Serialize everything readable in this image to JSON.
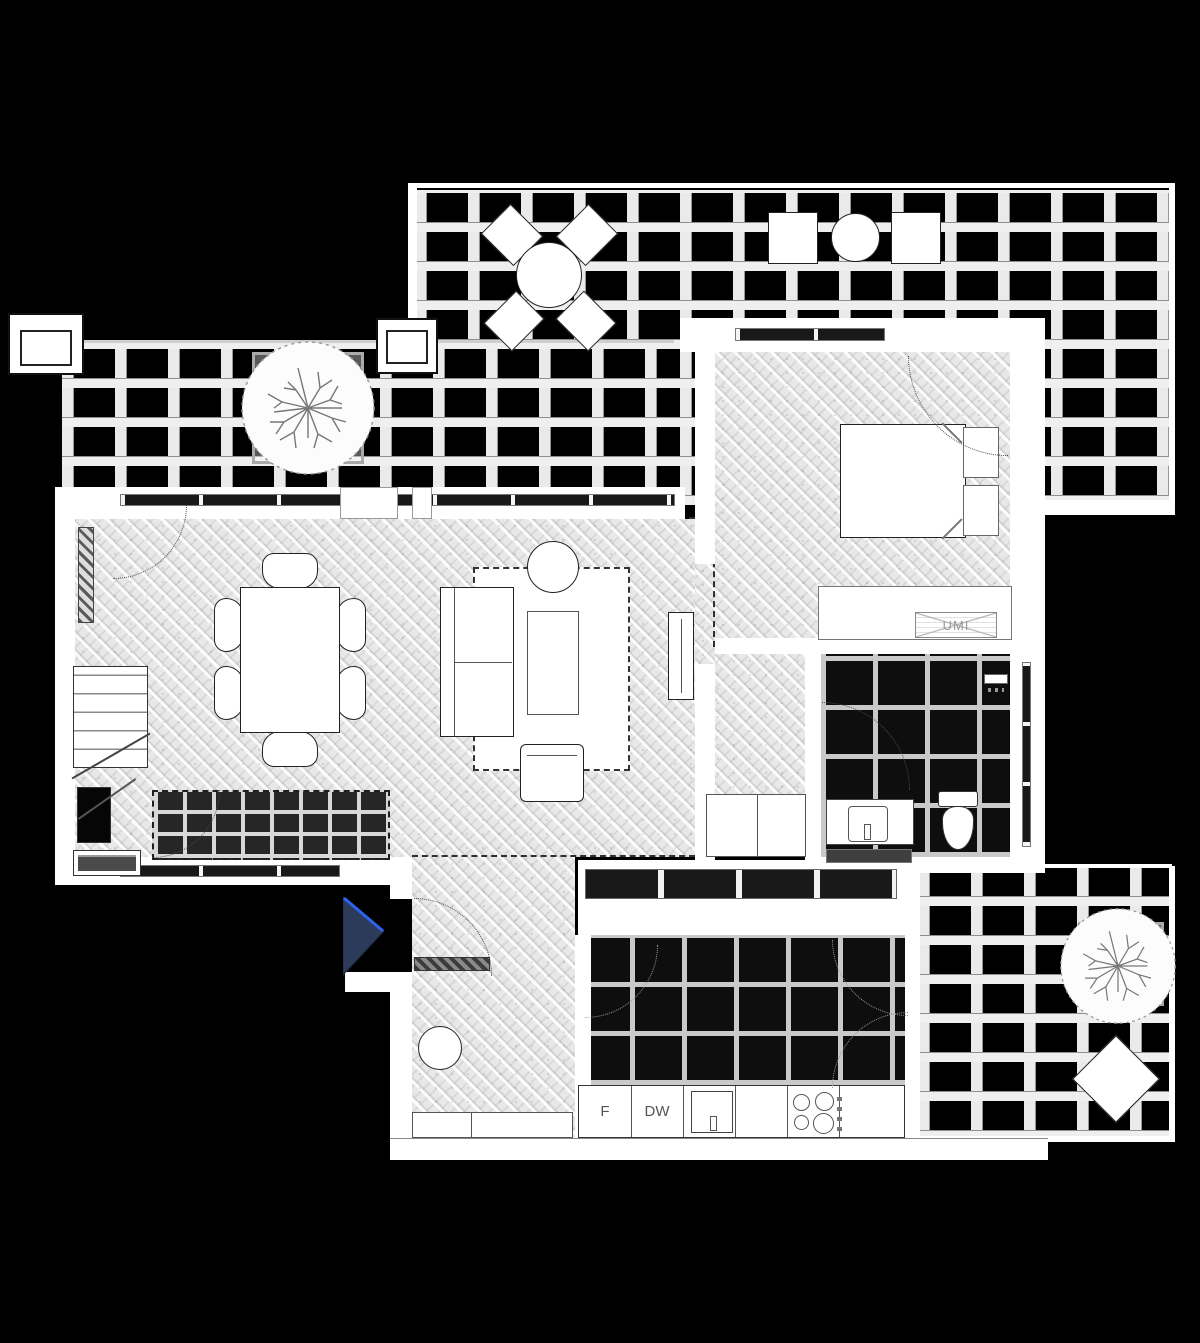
{
  "plan": {
    "labels": {
      "washer_unit": "UMI",
      "fridge": "F",
      "dishwasher": "DW"
    },
    "colors": {
      "background": "#000000",
      "walls": "#ffffff",
      "parquet_floor": "#e8e8e8",
      "dark_tile_floor": "#0e0e0e",
      "deck_plank": "#eaeaea",
      "deck_shadow": "#979797",
      "entrance_marker_fill": "#2c3b59",
      "entrance_marker_edge": "#2e63f0"
    },
    "icons": {
      "tree": "tree-canopy-icon",
      "shower": "shower-icon",
      "cooktop": "cooktop-burners-icon",
      "sink": "sink-icon",
      "toilet": "toilet-icon",
      "entrance_arrow": "entrance-arrow-icon"
    }
  }
}
